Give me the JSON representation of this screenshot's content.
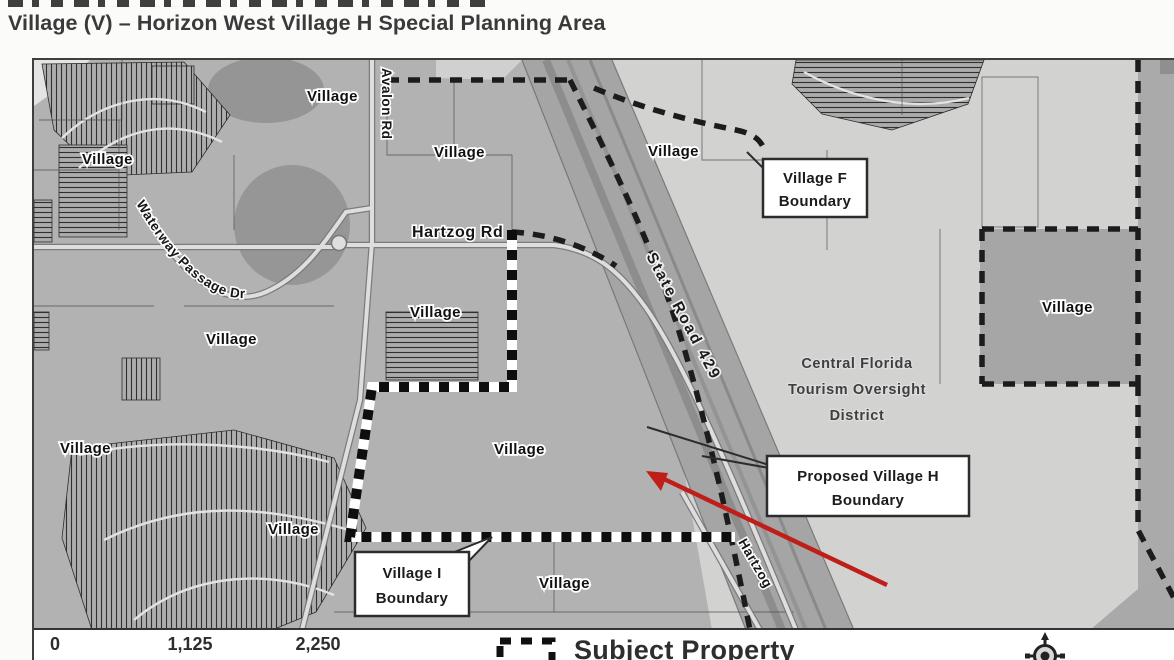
{
  "subtitle": "Village (V) – Horizon West Village H Special Planning Area",
  "map": {
    "village_label": "Village",
    "roads": {
      "avalon": "Avalon Rd",
      "hartzog": "Hartzog Rd",
      "waterway": "Waterway Passage Dr",
      "state_road_429": "State Road 429",
      "hartzog_diagonal": "Hartzog"
    },
    "district": {
      "line1": "Central Florida",
      "line2": "Tourism Oversight",
      "line3": "District"
    },
    "callouts": {
      "village_f": {
        "line1": "Village F",
        "line2": "Boundary"
      },
      "proposed_village_h": {
        "line1": "Proposed Village H",
        "line2": "Boundary"
      },
      "village_i": {
        "line1": "Village I",
        "line2": "Boundary"
      }
    }
  },
  "footer": {
    "scale": {
      "tick0": "0",
      "tick1": "1,125",
      "tick2": "2,250"
    },
    "legend": {
      "subject_property": "Subject Property"
    }
  },
  "colors": {
    "annotation_arrow": "#bf1f18",
    "map_base": "#b2b2b2",
    "district_area": "#d2d2d0",
    "boundary_dark": "#1c1c1c"
  }
}
